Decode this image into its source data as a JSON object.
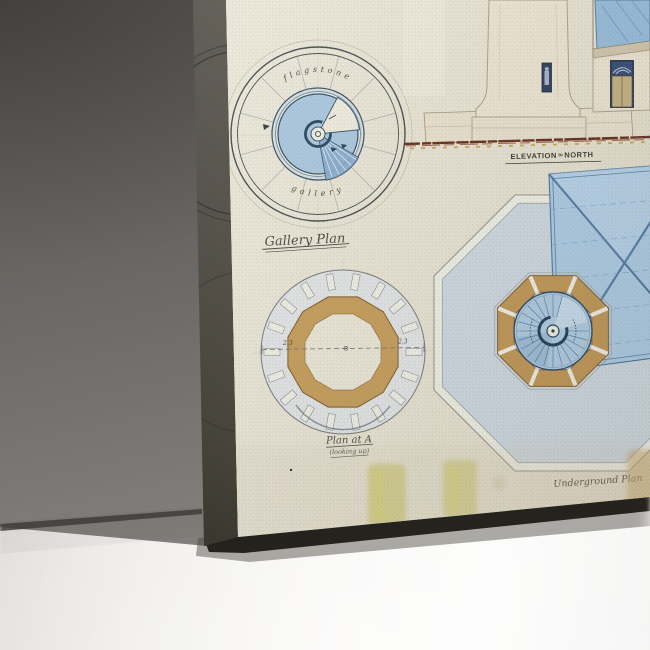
{
  "scene": {
    "description": "Canvas print of an antique lighthouse architectural drawing leaning against a grey wall on a white floor",
    "wall_color_top": "#55524f",
    "wall_color_bottom": "#928e8b",
    "floor_color": "#f7f6f4",
    "canvas_side_color": "#4e4a42",
    "paper_color": "#ebe8da"
  },
  "artwork": {
    "gallery_plan": {
      "label": "Gallery Plan",
      "curved_top": "flagstone",
      "curved_bottom": "gallery",
      "ink_color": "#3d4248",
      "blue_fill": "#a6c6e1",
      "blue_dark": "#7fa9cf",
      "navy": "#24455f"
    },
    "elevation": {
      "label_main": "ELEVATION",
      "label_mid": "to",
      "label_end": "NORTH",
      "stone_color": "#ece5d4",
      "roof_color": "#8fb9dc",
      "door_color": "#1e3156",
      "ground_color": "#5c2110",
      "ochre_color": "#c09a3a"
    },
    "plan_at_a": {
      "label": "Plan at A",
      "sublabel": "(looking up)",
      "dim_left": "2.3",
      "dim_right": "2.3",
      "ring_color": "#c39a55",
      "field_color": "#e2e6ea"
    },
    "underground_plan": {
      "label": "Underground Plan",
      "roof_fill": "#a9cbe8",
      "roof_line": "#2e5d90",
      "octagon_fill": "#ccd9e4",
      "ring_color": "#bd9350",
      "stair_fill": "#abcbe6",
      "navy": "#16334f"
    },
    "smudge_color": "#c2bd55"
  }
}
